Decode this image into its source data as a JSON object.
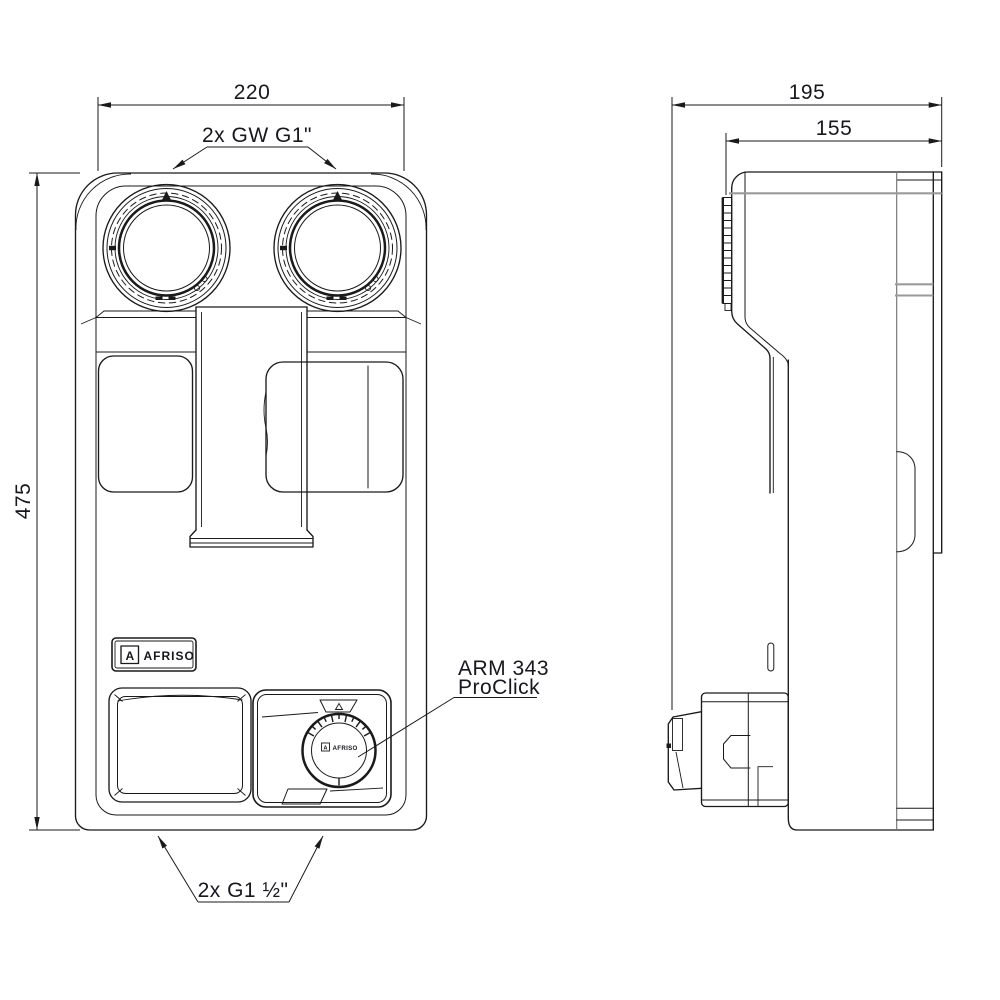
{
  "drawing": {
    "dimensions": {
      "front_width": "220",
      "front_height": "475",
      "side_depth": "195",
      "side_depth_inner": "155"
    },
    "labels": {
      "top_ports": "2x GW G1\"",
      "bottom_ports": "2x G1 ½\"",
      "actuator_line1": "ARM 343",
      "actuator_line2": "ProClick"
    },
    "brand": {
      "mark": "A",
      "name": "AFRISO",
      "dial_mark": "A",
      "dial_name": "AFRISO"
    },
    "colors": {
      "line": "#1a1a1a",
      "gray_line": "#9a9a9a",
      "text": "#17171c",
      "background": "#ffffff"
    }
  }
}
